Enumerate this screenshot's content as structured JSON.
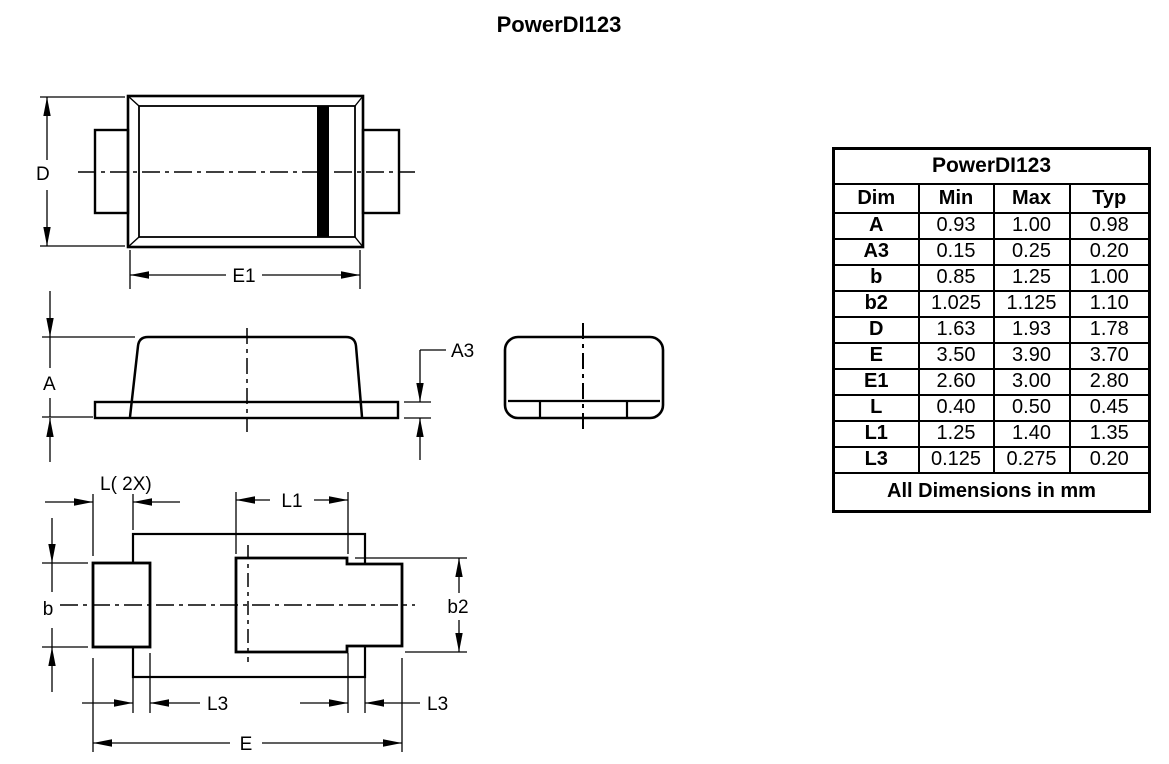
{
  "page_title": "PowerDI123",
  "colors": {
    "ink": "#000000",
    "background": "#ffffff"
  },
  "drawing": {
    "labels": {
      "d": "D",
      "e1": "E1",
      "a": "A",
      "a3": "A3",
      "l_2x": "L( 2X)",
      "l1": "L1",
      "b": "b",
      "b2": "b2",
      "l3": "L3",
      "e": "E"
    }
  },
  "table": {
    "title": "PowerDI123",
    "columns": [
      "Dim",
      "Min",
      "Max",
      "Typ"
    ],
    "rows": [
      [
        "A",
        "0.93",
        "1.00",
        "0.98"
      ],
      [
        "A3",
        "0.15",
        "0.25",
        "0.20"
      ],
      [
        "b",
        "0.85",
        "1.25",
        "1.00"
      ],
      [
        "b2",
        "1.025",
        "1.125",
        "1.10"
      ],
      [
        "D",
        "1.63",
        "1.93",
        "1.78"
      ],
      [
        "E",
        "3.50",
        "3.90",
        "3.70"
      ],
      [
        "E1",
        "2.60",
        "3.00",
        "2.80"
      ],
      [
        "L",
        "0.40",
        "0.50",
        "0.45"
      ],
      [
        "L1",
        "1.25",
        "1.40",
        "1.35"
      ],
      [
        "L3",
        "0.125",
        "0.275",
        "0.20"
      ]
    ],
    "footer": "All Dimensions in mm"
  }
}
